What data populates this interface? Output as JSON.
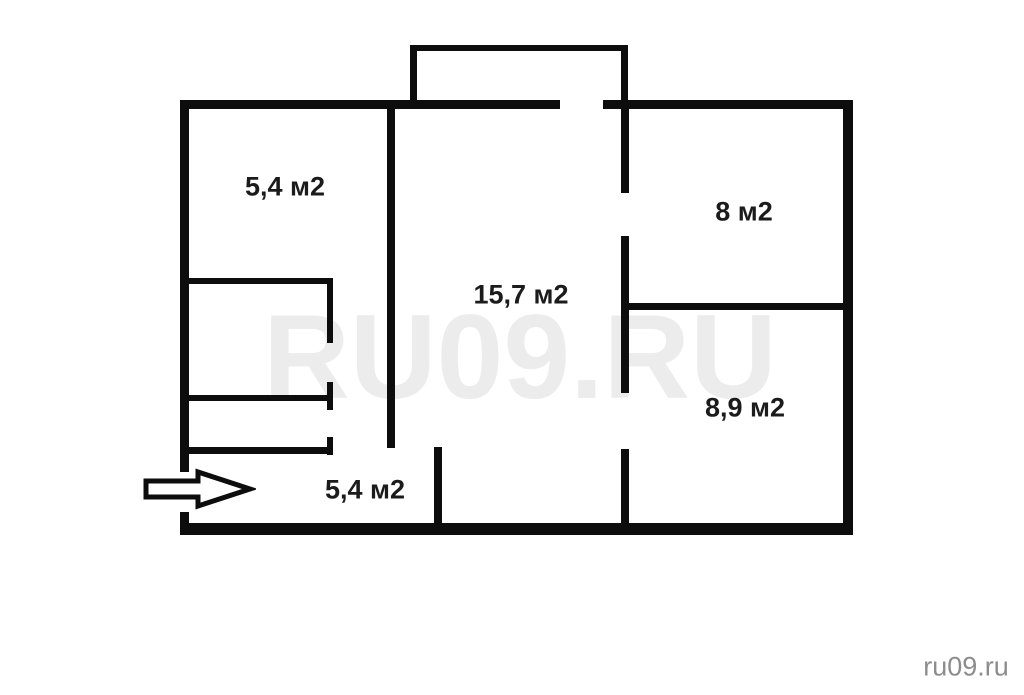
{
  "plan": {
    "title": "apartment-floor-plan",
    "rooms": [
      {
        "name": "room-top-left",
        "area_label": "5,4 м2"
      },
      {
        "name": "room-top-right",
        "area_label": "8 м2"
      },
      {
        "name": "room-living",
        "area_label": "15,7 м2"
      },
      {
        "name": "room-bottom-right",
        "area_label": "8,9 м2"
      },
      {
        "name": "hallway",
        "area_label": "5,4 м2"
      }
    ],
    "features": [
      "balcony",
      "entrance-arrow",
      "closet",
      "wc"
    ]
  },
  "watermark": {
    "text": "RU09.RU"
  },
  "footer": {
    "site_label": "ru09.ru"
  },
  "colors": {
    "wall": "#0d0d0d",
    "label": "#1b1b1b",
    "watermark": "#ececec",
    "site": "#8c8c8c",
    "bg": "#ffffff"
  }
}
